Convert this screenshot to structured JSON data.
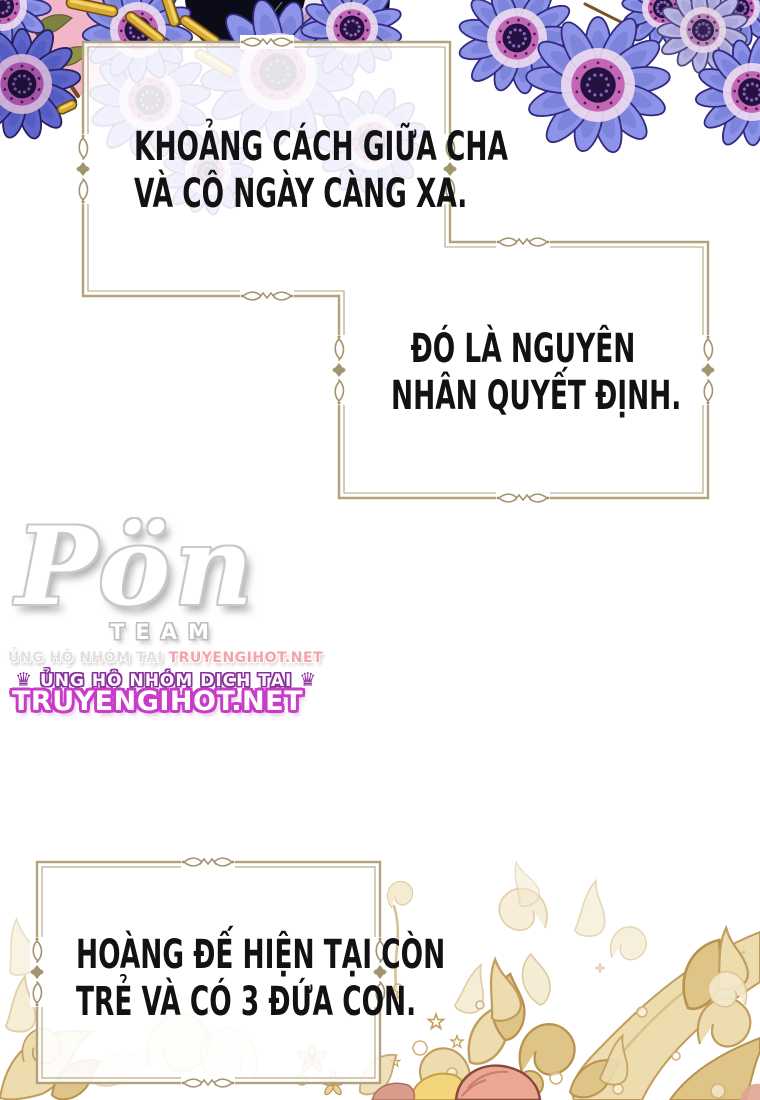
{
  "panel1": {
    "lines": [
      "KHOẢNG CÁCH GIỮA CHA",
      "VÀ CÔ NGÀY CÀNG XA."
    ]
  },
  "panel2": {
    "lines": [
      "ĐÓ LÀ NGUYÊN",
      "NHÂN QUYẾT ĐỊNH."
    ]
  },
  "panel3": {
    "lines": [
      "HOÀNG ĐẾ HIỆN TẠI CÒN",
      "TRẺ VÀ CÓ 3 ĐỨA CON."
    ]
  },
  "watermark": {
    "logo_script": "Pön",
    "team_label": "TEAM",
    "support_prefix": "ỦNG HỘ NHÓM TẠI",
    "support_site": "TRUYENGIHOT.NET",
    "crown_left": "♛",
    "support_line2": "ỦNG HỘ NHÓM DỊCH TẠI",
    "crown_right": "♛",
    "site_big": "TRUYENGIHOT.NET"
  },
  "colors": {
    "frame": "#b2a37d",
    "flower_petal": "#8d94e8",
    "flower_center": "#241140",
    "flower_ring": "#c466b6",
    "pink_backdrop": "#f3b6c8",
    "gold_ornament": "#dfc488",
    "watermark_magenta": "#c83dc8",
    "watermark_purple": "#8a2f9e"
  }
}
